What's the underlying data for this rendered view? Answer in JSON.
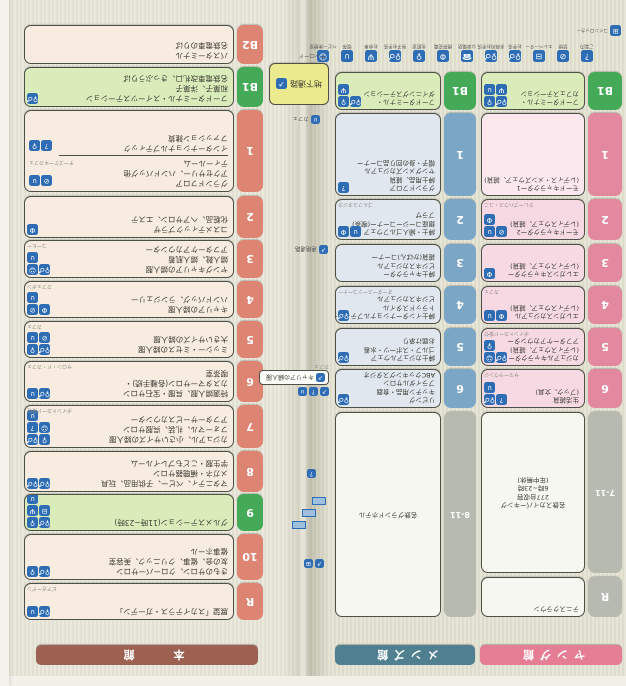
{
  "buildings": [
    {
      "id": "young",
      "name": "ヤング館",
      "banner_color": "#e57e95",
      "floors": [
        {
          "label": "R",
          "tab": "grey",
          "bg": "white",
          "lines": [
            "テニスクラウン"
          ],
          "icons": [],
          "note": ""
        },
        {
          "label": "7-11",
          "tab": "grey",
          "bg": "white",
          "lines": [
            "名鉄スカイパーキング",
            "277台収容",
            "6時~23時",
            "(年中無休)"
          ],
          "icons": [],
          "note": "",
          "center": true
        },
        {
          "label": "6",
          "tab": "pink",
          "bg": "pink",
          "lines": [
            "生活雑貨",
            "(ブック、文具)"
          ],
          "icons": [
            "info",
            "restroom",
            "cafe"
          ],
          "note": "サマーラウンジ"
        },
        {
          "label": "5",
          "tab": "pink",
          "bg": "pink",
          "lines": [
            "カジュアルキャラクター",
            "(レディスウェア、雑貨)",
            "アフターケアカウンター"
          ],
          "icons": [
            "restroom",
            "baby",
            "female"
          ],
          "note": "ポイントカード受付"
        },
        {
          "label": "4",
          "tab": "pink",
          "bg": "pink",
          "lines": [
            "エレガンスカジュアル",
            "(レディスウェア、雑貨)"
          ],
          "icons": [
            "service",
            "cafe"
          ],
          "note": "カフェ"
        },
        {
          "label": "3",
          "tab": "pink",
          "bg": "pink",
          "lines": [
            "エレガンスキャラクター",
            "(レディスウェア、雑貨)"
          ],
          "icons": [
            "service"
          ],
          "note": ""
        },
        {
          "label": "2",
          "tab": "pink",
          "bg": "pink",
          "lines": [
            "モードキャラクター2",
            "(レディスウェア、雑貨)"
          ],
          "icons": [
            "nosmoke",
            "cafe",
            "service"
          ],
          "note": "クレープハウス・ユニ"
        },
        {
          "label": "1",
          "tab": "pink",
          "bg": "pinkL",
          "lines": [
            "モードキャラクター1",
            "(レディス・メンズウェア、雑貨)"
          ],
          "icons": [],
          "note": ""
        },
        {
          "label": "B1",
          "tab": "green",
          "bg": "green",
          "lines": [
            "フードターミナル・",
            "カフェステーション"
          ],
          "icons": [
            "restroom",
            "female",
            "restaurant",
            "cafe"
          ],
          "note": ""
        }
      ]
    },
    {
      "id": "mens",
      "name": "メンズ館",
      "banner_color": "#50808f",
      "floors": [
        {
          "label": "8-11",
          "tab": "grey",
          "bg": "white",
          "lines": [
            "名鉄グランドホテル"
          ],
          "icons": [],
          "note": "",
          "center": true
        },
        {
          "label": "6",
          "tab": "blue",
          "bg": "blue",
          "lines": [
            "リビング",
            "キッチン用品・食器",
            "ブライダルサロン",
            "ABCクッキングスタジオ"
          ],
          "icons": [
            "restroom"
          ],
          "note": ""
        },
        {
          "label": "5",
          "tab": "blue",
          "bg": "blue",
          "lines": [
            "紳士カジュアルウェア",
            "ゴルフ・スポーツ・水着",
            "お届け承り"
          ],
          "icons": [
            "restroom"
          ],
          "note": ""
        },
        {
          "label": "4",
          "tab": "blue",
          "bg": "blue",
          "lines": [
            "紳士インターナショナルブティック・",
            "トラッドスタイル",
            "ビジネスカジュアル"
          ],
          "icons": [
            "restroom"
          ],
          "note": "オーダースーツコーナー"
        },
        {
          "label": "3",
          "tab": "blue",
          "bg": "blue",
          "lines": [
            "紳士キャラクター",
            "ビジネスカジュアル",
            "雑貨(かばん)コーナー"
          ],
          "icons": [],
          "note": ""
        },
        {
          "label": "2",
          "tab": "blue",
          "bg": "blue",
          "lines": [
            "紳士・婦人ゴルフウェア",
            "銀座コージーコーナー(喫茶)",
            "プラザ"
          ],
          "icons": [
            "cafe",
            "service"
          ],
          "note": "ゴルフスタジオ"
        },
        {
          "label": "1",
          "tab": "blue",
          "bg": "blue",
          "lines": [
            "グランドフロア",
            "紳士用品、雑貨",
            "ヤングメンズカジュアル",
            "帽子・身の回り品コーナー"
          ],
          "icons": [
            "info"
          ],
          "note": ""
        },
        {
          "label": "B1",
          "tab": "green",
          "bg": "green",
          "lines": [
            "フードターミナル・",
            "ダイニングステーション"
          ],
          "icons": [
            "restroom",
            "female",
            "restaurant"
          ],
          "note": ""
        }
      ]
    },
    {
      "id": "honkan",
      "name": "本　館",
      "banner_color": "#9c6150",
      "floors": [
        {
          "label": "R",
          "tab": "salmon",
          "bg": "cream",
          "lines": [
            "展望「スカイテラス・ガーデン」"
          ],
          "icons": [
            "restroom",
            "cafe"
          ],
          "note": "ビアガーデン"
        },
        {
          "label": "10",
          "tab": "salmon",
          "bg": "cream",
          "lines": [
            "きものサロン、クローバーサロン",
            "友の会、催事、クリニック、美容室",
            "催事ホール"
          ],
          "icons": [
            "restroom",
            "female"
          ],
          "note": ""
        },
        {
          "label": "9",
          "tab": "green",
          "bg": "green",
          "lines": [
            "グルメステーション(11時~23時)"
          ],
          "icons": [
            "restroom",
            "female",
            "elevator",
            "restaurant",
            "cafe"
          ],
          "note": ""
        },
        {
          "label": "8",
          "tab": "salmon",
          "bg": "cream",
          "lines": [
            "マタニティ、ベビー、子供用品、玩具",
            "メガネ・補聴器サロン",
            "学生服・こどもプレイルーム"
          ],
          "icons": [
            "restroom",
            "restroom"
          ],
          "note": ""
        },
        {
          "label": "7",
          "tab": "salmon",
          "bg": "cream",
          "lines": [
            "カジュアル、小さいサイズの婦人服",
            "フォーマル、礼装、呉服サロン",
            "アフターサービスカウンター"
          ],
          "icons": [
            "female",
            "restroom",
            "baby",
            "info",
            "cafe"
          ],
          "note": "ポイントカード受付"
        },
        {
          "label": "6",
          "tab": "salmon",
          "bg": "cream",
          "lines": [
            "特選婦人服、呉服・宝石サロン",
            "カスタマーサロン(各種手続)・",
            "喫茶室"
          ],
          "icons": [
            "restroom",
            "cafe"
          ],
          "note": "サロン・ド・カフェ"
        },
        {
          "label": "5",
          "tab": "salmon",
          "bg": "cream",
          "lines": [
            "ミッシー・ミセスの婦人服",
            "大きいサイズの婦人服"
          ],
          "icons": [
            "restroom",
            "female",
            "nosmoke",
            "cafe"
          ],
          "note": "カフェ"
        },
        {
          "label": "4",
          "tab": "salmon",
          "bg": "cream",
          "lines": [
            "キャリアの婦人服",
            "ハンドバッグ、ランジェリー"
          ],
          "icons": [
            "service",
            "nosmoke",
            "cafe"
          ],
          "note": "カフェボン"
        },
        {
          "label": "3",
          "tab": "salmon",
          "bg": "cream",
          "lines": [
            "ヤングキャリアの婦人服",
            "婦人靴、婦人肌着",
            "アフターケアカウンター"
          ],
          "icons": [
            "restroom",
            "baby",
            "cafe"
          ],
          "note": "コーヒー"
        },
        {
          "label": "2",
          "tab": "salmon",
          "bg": "cream",
          "lines": [
            "コスメティックプラザ",
            "化粧品、ヘアサロン、エステ"
          ],
          "icons": [
            "service"
          ],
          "note": ""
        },
        {
          "label": "1",
          "tab": "salmon",
          "bg": "cream",
          "sections": [
            {
              "lines": [
                "グランドフロア",
                "アクセサリー、ハンドバッグ他",
                "ティールーム"
              ],
              "icons": [
                "nosmoke",
                "cafe"
              ],
              "note": "チーズケーキカフェ"
            },
            {
              "lines": [
                "インターナショナルブティック",
                "ファッション雑貨"
              ],
              "icons": [
                "info",
                "female"
              ],
              "note": ""
            }
          ]
        },
        {
          "label": "B1",
          "tab": "green",
          "bg": "green",
          "lines": [
            "フードターミナル・スイーツステーション",
            "和菓子、洋菓子",
            "名鉄電車改札口、きっぷうりば"
          ],
          "icons": [
            "restroom"
          ],
          "note": ""
        },
        {
          "label": "B2",
          "tab": "salmon",
          "bg": "cream",
          "lines": [
            "バスターミナル",
            "名鉄電車のりば"
          ],
          "icons": [],
          "note": ""
        }
      ]
    }
  ],
  "legend": {
    "items": [
      {
        "icon": "info",
        "label": "ご案内"
      },
      {
        "icon": "nosmoke",
        "label": "禁煙"
      },
      {
        "icon": "elevator",
        "label": "エレベーター"
      },
      {
        "icon": "restroom",
        "label": "お手洗"
      },
      {
        "icon": "restroom",
        "label": "多目的お手洗"
      },
      {
        "icon": "phone",
        "label": "公衆電話"
      },
      {
        "icon": "service",
        "label": "携帯充電"
      },
      {
        "icon": "female",
        "label": "化粧室"
      },
      {
        "icon": "restroom",
        "label": "男子お手洗"
      },
      {
        "icon": "restaurant",
        "label": "お食事"
      },
      {
        "icon": "cafe",
        "label": "喫茶"
      },
      {
        "icon": "baby",
        "label": "ベビー休憩室"
      }
    ],
    "corner": {
      "icon": "screen",
      "label": "コインロッカー"
    }
  },
  "fold": {
    "underpass_label": "地下通路",
    "underpass_note": "サンロード",
    "cafe_note": "カフェ",
    "bridge_label": "連絡通路",
    "callout_text": "キャリアの婦人服",
    "callout_note": "カフェ"
  },
  "colors": {
    "tab_salmon": "#dd8473",
    "tab_green": "#44aa57",
    "tab_blue": "#7ba6c6",
    "tab_pink": "#e289a0",
    "tab_grey": "#b6bab0",
    "chip_blue": "#2e6db4",
    "banner_honkan": "#9c6150",
    "banner_mens": "#50808f",
    "banner_young": "#e57e95"
  }
}
